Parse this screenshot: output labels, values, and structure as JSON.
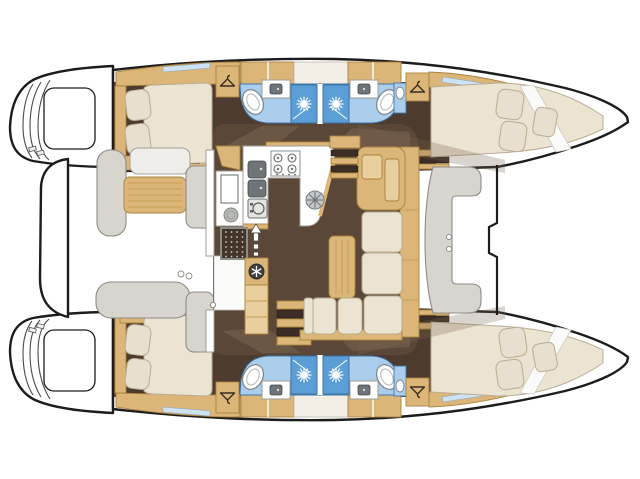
{
  "document": {
    "kind": "yacht floor plan",
    "subject": "catamaran sailing yacht — top-down accommodation / deck plan",
    "orientation": {
      "bow": "right",
      "stern": "left",
      "port_hull": "top",
      "starboard_hull": "bottom"
    },
    "canvas": {
      "width_px": 640,
      "height_px": 479
    },
    "visible_text": []
  },
  "palette": {
    "outline": "#1c1c1c",
    "line": "#c9c5bf",
    "floor": "#4e3b2f",
    "floor2": "#5b4738",
    "wallLight": "#7a6450",
    "wood": "#dcb679",
    "woodLight": "#e9cf9d",
    "woodEdge": "#a9833f",
    "woodGrain": "#c79c54",
    "slatDark": "#3c2e24",
    "cream": "#ece4d2",
    "creamEdge": "#b9ac90",
    "pillow": "#e7dfcf",
    "bath": "#a9cdea",
    "bathEdge": "#3f76a8",
    "shower": "#5b9ed6",
    "bench": "#d8d4ce",
    "benchEdge": "#8f8b85",
    "appl": "#6e7478",
    "window": "#cfe2f2"
  },
  "icons": [
    {
      "name": "hanger-icon",
      "meaning": "wardrobe / hanging locker",
      "instances": 4
    },
    {
      "name": "sun-icon",
      "meaning": "shower stall",
      "instances": 4
    },
    {
      "name": "snowflake-icon",
      "meaning": "refrigerator",
      "instances": 1
    },
    {
      "name": "burner-icon",
      "meaning": "4-burner stove top",
      "instances": 1
    },
    {
      "name": "up-arrow-icon",
      "meaning": "salon entry from cockpit",
      "instances": 1
    }
  ],
  "layout": {
    "salon": [
      "u-shaped-galley",
      "stove",
      "double-sink",
      "oven",
      "round-sink",
      "refrigerator",
      "floor-hatch",
      "chart-table",
      "l-shaped-sofa",
      "salon-table",
      "stairs-to-port-hull",
      "stairs-to-starboard-hull",
      "entry-vestibule"
    ],
    "aft_cockpit": [
      "cockpit-table",
      "side-bench",
      "aft-bench",
      "backrest-benches",
      "aft-crossbeam-platform"
    ],
    "forward_cockpit": [
      "c-shaped-bench",
      "cup-holders",
      "forward-crossbeam"
    ],
    "port_hull": [
      "stern-swim-platform",
      "aft-double-cabin",
      "aft-bathroom-with-shower",
      "forward-bathroom-with-shower",
      "forward-double-cabin-in-bow"
    ],
    "starboard_hull": [
      "stern-swim-platform",
      "aft-double-cabin",
      "aft-bathroom-with-shower",
      "forward-bathroom-with-shower",
      "forward-double-cabin-in-bow"
    ],
    "between_bows": "open trampoline area"
  },
  "counts": {
    "double_cabins": 4,
    "bathrooms": 4,
    "showers": 4,
    "toilets": 4,
    "wardrobes": 4,
    "hulls": 2
  }
}
